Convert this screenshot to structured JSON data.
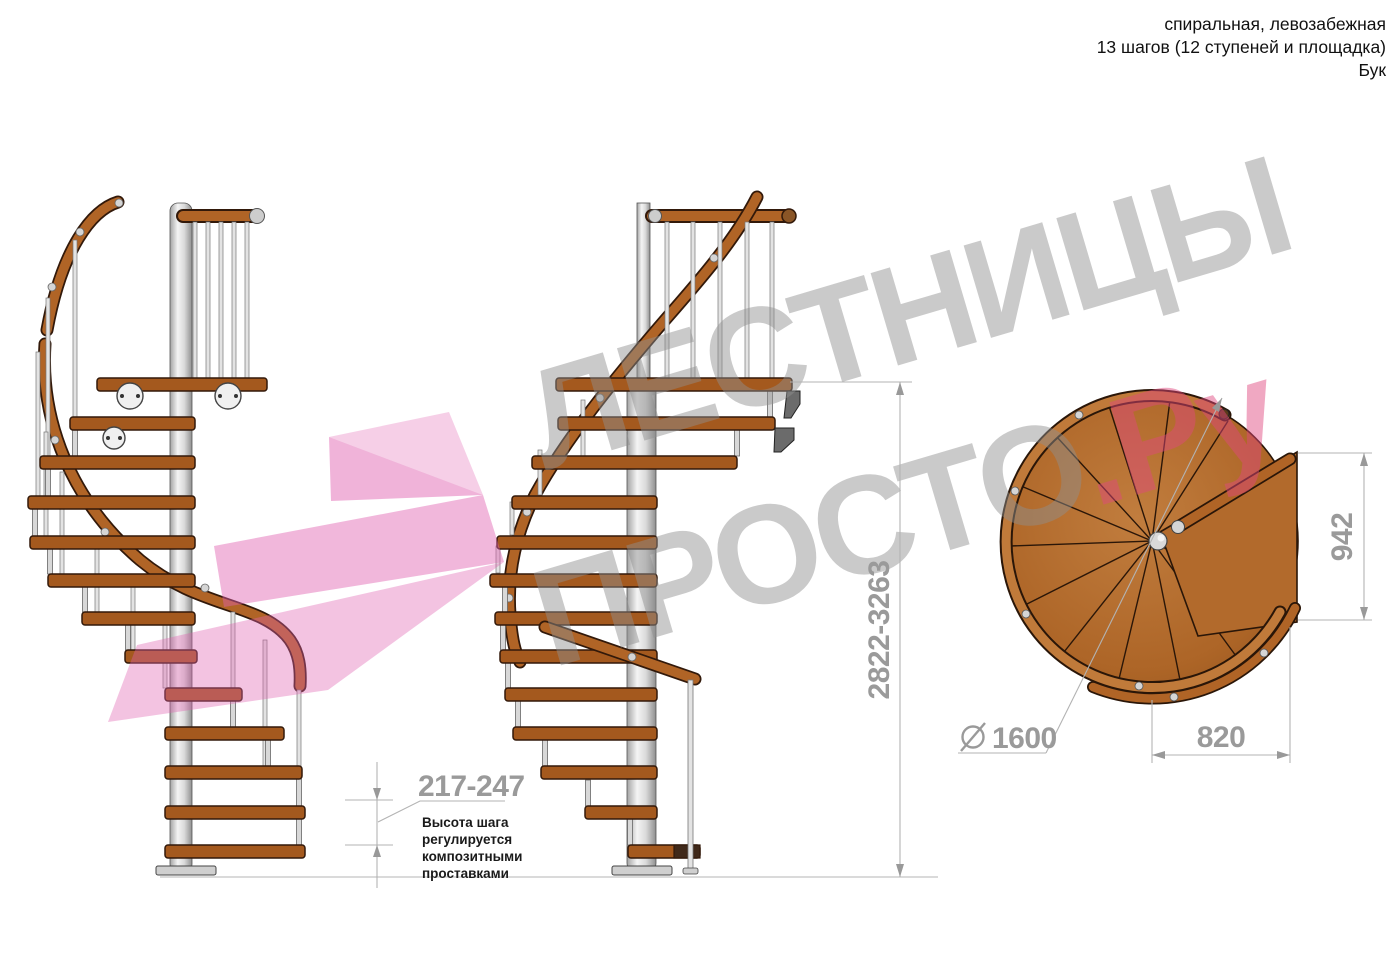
{
  "header": {
    "line1": "спиральная, левозабежная",
    "line2": "13 шагов (12 ступеней и площадка)",
    "line3": "Бук"
  },
  "watermark": {
    "line1": "ЛЕСТНИЦЫ",
    "line2": "ПРОСТО",
    "suffix": ".Ру",
    "gray_color": "#8f8f8f",
    "pink_color": "#e0487f",
    "arrow_color": "#e060b0"
  },
  "dimensions": {
    "step_height": {
      "value": "217-247"
    },
    "total_height": {
      "value": "2822-3263"
    },
    "plan_depth": {
      "value": "942"
    },
    "landing_width": {
      "value": "820"
    },
    "diameter": {
      "symbol": "⌀",
      "value": "1600"
    }
  },
  "annotations": {
    "note_lines": [
      "Высота шага",
      "регулируется",
      "композитными",
      "проставками"
    ]
  },
  "colors": {
    "wood": "#a4591e",
    "wood_rim": "#c07a3a",
    "rail": "#b06426",
    "outline": "#32190a",
    "pole": "#d9d9d9",
    "dim_text": "#9a9a9a",
    "dim_line": "#b3b3b3",
    "annotation_text": "#1a1a1a"
  }
}
